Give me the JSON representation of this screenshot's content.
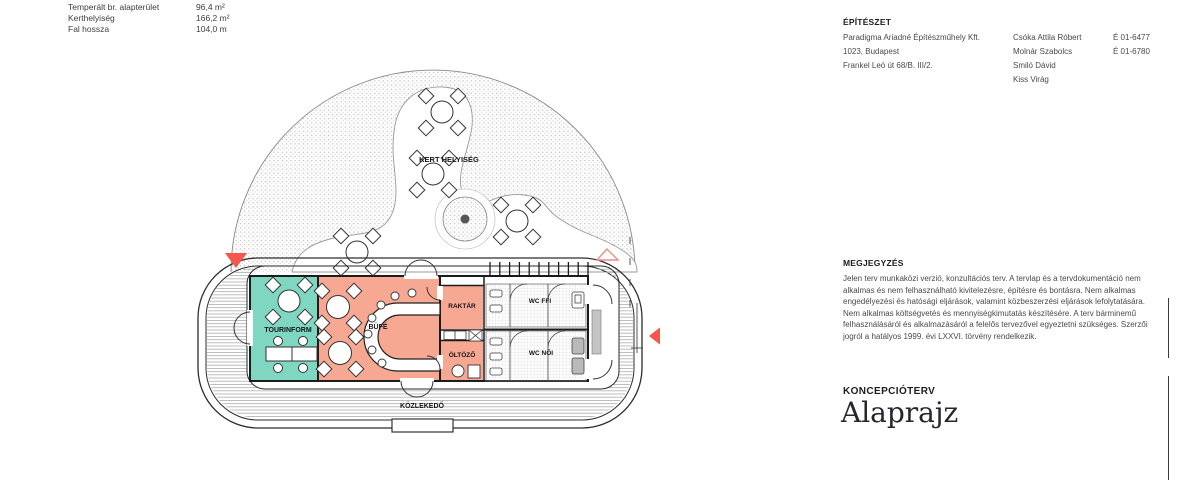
{
  "stats": {
    "rows": [
      {
        "label": "Temperált br. alapterület",
        "value": "96,4 m²"
      },
      {
        "label": "Kerthelyiség",
        "value": "166,2 m²"
      },
      {
        "label": "Fal hossza",
        "value": "104,0 m"
      }
    ]
  },
  "title_block": {
    "section_title": "ÉPÍTÉSZET",
    "company": {
      "name": "Paradigma Ariadné Építészműhely Kft.",
      "address1": "1023, Budapest",
      "address2": "Frankel Leó út 68/B. III/2."
    },
    "architects": [
      {
        "name": "Csóka Attila Róbert"
      },
      {
        "name": "Molnár Szabolcs"
      },
      {
        "name": "Smiló Dávid"
      },
      {
        "name": "Kiss Virág"
      }
    ],
    "licenses": [
      "É 01-6477",
      "É 01-6780"
    ],
    "notes_title": "MEGJEGYZÉS",
    "notes_body": "Jelen terv munkaközi verzió, konzultációs terv. A tervlap és a tervdokumentáció nem alkalmas és nem felhasználható kivitelezésre, építésre és bontásra. Nem alkalmas engedélyezési és hatósági eljárások, valamint közbeszerzési eljárások lefolytatására. Nem alkalmas költségvetés és mennyiségkimutatás készítésére. A terv bárminemű felhasználásáról és alkalmazásáról a felelős tervezővel egyeztetni szükséges. Szerzői jogról a hatályos 1999. évi LXXVI. törvény rendelkezik.",
    "phase_label": "KONCEPCIÓTERV",
    "drawing_title": "Alaprajz"
  },
  "plan": {
    "rooms": {
      "tourinform": "TOURINFORM",
      "bufe": "BÜFÉ",
      "raktar": "RAKTÁR",
      "oltozo": "ÖLTÖZŐ",
      "wc_ffi": "WC FFI",
      "wc_noi": "WC NŐI",
      "kozlekedo": "KÖZLEKEDŐ",
      "kert": "KERT HELYISÉG"
    },
    "colors": {
      "tourinform": "#7FD6C1",
      "bufe": "#F6A893",
      "marker_red": "#F4574C",
      "marker_outline": "#EE8C86"
    }
  }
}
